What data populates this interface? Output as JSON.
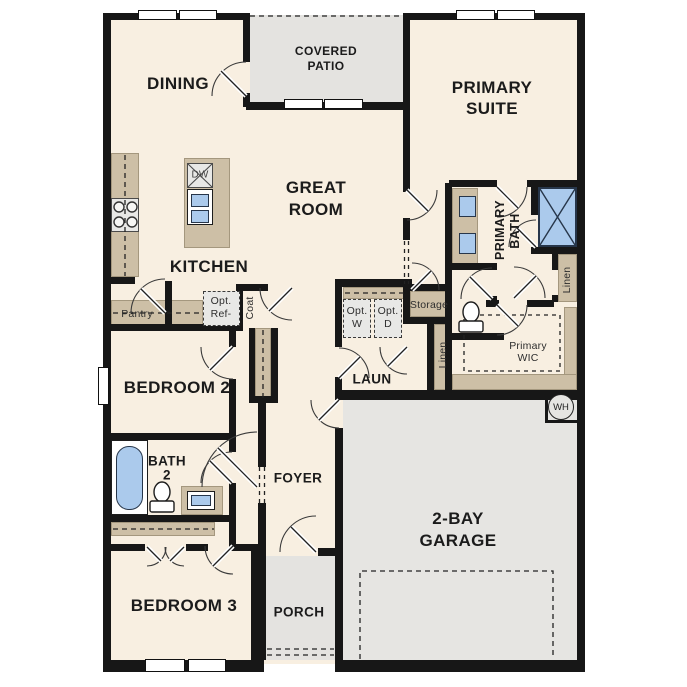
{
  "colors": {
    "floor": "#f8efe1",
    "outdoor": "#e4e3e0",
    "garage": "#e6e5e2",
    "cabinet": "#cdbfa6",
    "appliance": "#e8e8e6",
    "blue": "#abcaec",
    "wall": "#171717",
    "textDark": "#1b1b1b",
    "textSoft": "#2e2e2e"
  },
  "rooms": {
    "dining": "DINING",
    "covered_patio_1": "COVERED",
    "covered_patio_2": "PATIO",
    "primary_suite_1": "PRIMARY",
    "primary_suite_2": "SUITE",
    "great_room_1": "GREAT",
    "great_room_2": "ROOM",
    "kitchen": "KITCHEN",
    "primary_bath_1": "PRIMARY",
    "primary_bath_2": "BATH",
    "laundry": "LAUN",
    "bedroom2": "BEDROOM 2",
    "bath2_1": "BATH",
    "bath2_2": "2",
    "foyer": "FOYER",
    "bedroom3": "BEDROOM 3",
    "porch": "PORCH",
    "garage_1": "2-BAY",
    "garage_2": "GARAGE",
    "primary_wic_1": "Primary",
    "primary_wic_2": "WIC"
  },
  "features": {
    "pantry": "Pantry",
    "opt_ref_1": "Opt.",
    "opt_ref_2": "Ref-",
    "coat": "Coat",
    "opt_w_1": "Opt.",
    "opt_w_2": "W",
    "opt_d_1": "Opt.",
    "opt_d_2": "D",
    "storage": "Storage",
    "linen_hall": "Linen",
    "linen_primary": "Linen",
    "dishwasher": "DW",
    "water_heater": "WH"
  }
}
